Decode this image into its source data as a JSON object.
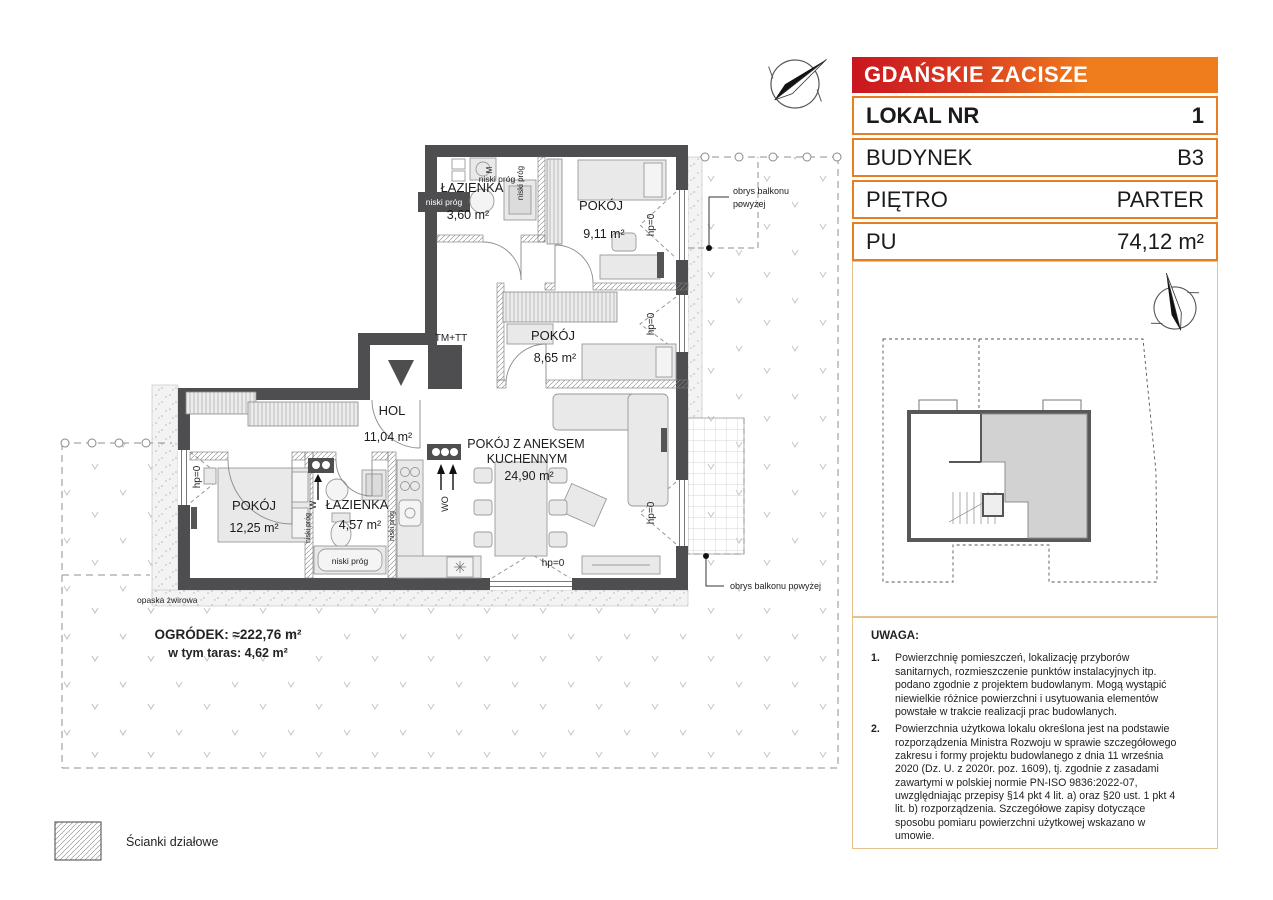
{
  "header": {
    "title": "GDAŃSKIE ZACISZE"
  },
  "info_table": {
    "rows": [
      {
        "label": "LOKAL NR",
        "value": "1"
      },
      {
        "label": "BUDYNEK",
        "value": "B3"
      },
      {
        "label": "PIĘTRO",
        "value": "PARTER"
      },
      {
        "label": "PU",
        "value": "74,12 m²"
      }
    ]
  },
  "floor_plan": {
    "rooms": [
      {
        "name": "ŁAZIENKA",
        "area": "3,60 m²"
      },
      {
        "name": "POKÓJ",
        "area": "9,11 m²"
      },
      {
        "name": "POKÓJ",
        "area": "8,65 m²"
      },
      {
        "name": "HOL",
        "area": "11,04 m²"
      },
      {
        "name": "POKÓJ Z ANEKSEM",
        "name2": "KUCHENNYM",
        "area": "24,90 m²"
      },
      {
        "name": "POKÓJ",
        "area": "12,25 m²"
      },
      {
        "name": "ŁAZIENKA",
        "area": "4,57 m²"
      }
    ],
    "labels": {
      "hp0": "hp=0",
      "niski_prog": "niski próg",
      "tm_tt": "TM+TT",
      "wo": "WO",
      "w": "W",
      "m": "M",
      "balcony_line1": "obrys balkonu",
      "balcony_line2": "powyżej",
      "balcony_full": "obrys balkonu powyżej",
      "gravel": "opaska żwirowa",
      "garden_line1": "OGRÓDEK: ≈222,76 m²",
      "garden_line2": "w tym taras: 4,62 m²"
    }
  },
  "legend": {
    "partition_walls": "Ścianki działowe"
  },
  "notes": {
    "title": "UWAGA:",
    "items": [
      {
        "num": "1.",
        "text": "Powierzchnię pomieszczeń, lokalizację przyborów sanitarnych, rozmieszczenie punktów instalacyjnych itp. podano zgodnie z projektem budowlanym. Mogą wystąpić niewielkie różnice powierzchni i usytuowania elementów powstałe w trakcie realizacji prac budowlanych."
      },
      {
        "num": "2.",
        "text": "Powierzchnia użytkowa lokalu określona jest na podstawie rozporządzenia Ministra Rozwoju w sprawie szczegółowego zakresu i formy projektu budowlanego z dnia 11 września 2020 (Dz. U. z 2020r. poz. 1609), tj. zgodnie z zasadami zawartymi w polskiej normie PN-ISO 9836:2022-07, uwzględniając przepisy §14 pkt 4 lit. a) oraz §20 ust. 1 pkt 4 lit. b) rozporządzenia. Szczegółowe zapisy dotyczące sposobu pomiaru powierzchni użytkowej wskazano w umowie."
      },
      {
        "num": "3.",
        "text": "Przedstawiona na rzucie aranżacja ma charakter przykładowy, umeblowanie i zabudowy instalacyjne nie stanowią wyposażenia nabywanego lokalu."
      }
    ]
  },
  "colors": {
    "brand_red": "#c9161f",
    "brand_orange": "#f07d1c",
    "table_border": "#e87e22",
    "panel_border": "#e6c190",
    "wall": "#4e4e50"
  }
}
